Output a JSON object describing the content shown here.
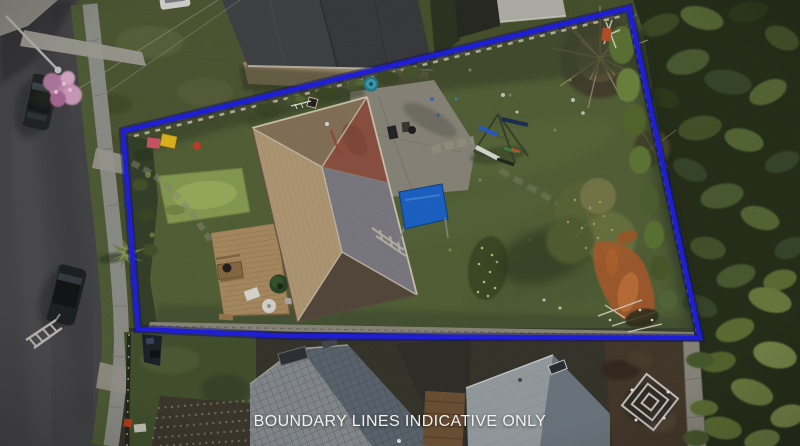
{
  "meta": {
    "type": "aerial-drone-photograph",
    "subject": "top-down view of residential property with boundary overlay"
  },
  "overlay": {
    "caption": "BOUNDARY LINES INDICATIVE ONLY",
    "caption_color": "#f2f2f0",
    "boundary_color": "#1d1ed6",
    "boundary_glow_color": "#11116e",
    "boundary_points": "123,131 629,8 700,338 290,336 138,329"
  }
}
